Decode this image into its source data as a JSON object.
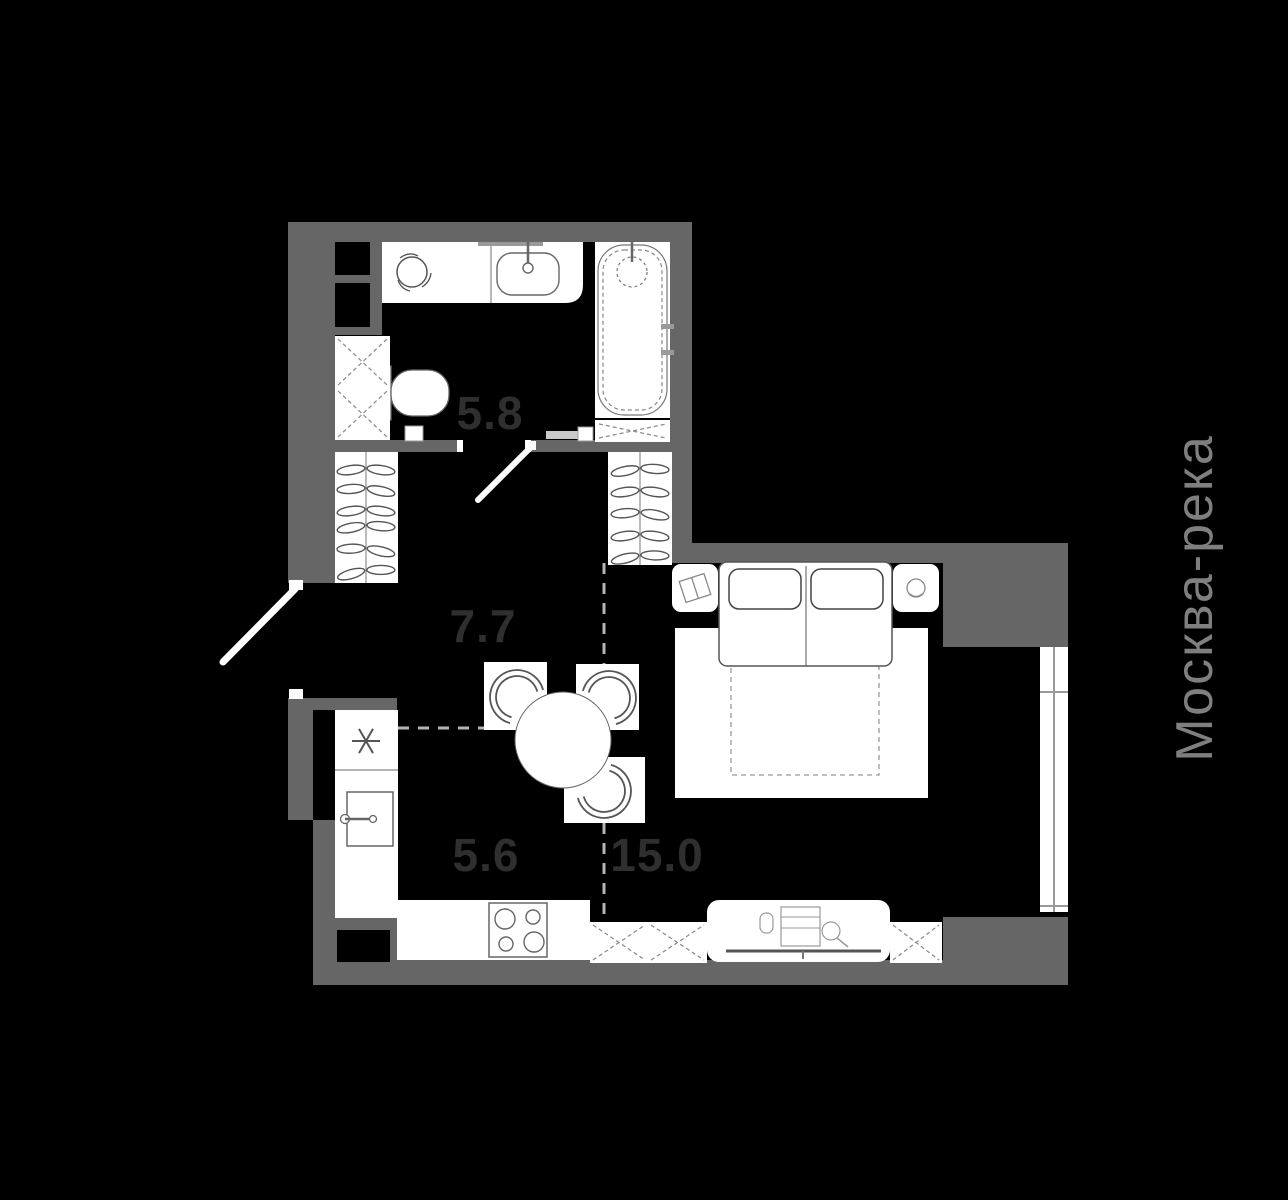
{
  "plan": {
    "type": "apartment-floor-plan",
    "colors": {
      "background": "#000000",
      "wall": "#666666",
      "floor": "#000000",
      "fixture_fill": "#ffffff",
      "fixture_stroke": "#666666",
      "room_label": "#2f2f2f",
      "river_label": "#7f7f7f",
      "zone_dash": "#b5b5b5"
    },
    "rooms": [
      {
        "name": "bathroom",
        "area": "5.8"
      },
      {
        "name": "hallway",
        "area": "7.7"
      },
      {
        "name": "kitchen",
        "area": "5.6"
      },
      {
        "name": "living-room",
        "area": "15.0"
      }
    ],
    "river_label": "Москва-река"
  }
}
